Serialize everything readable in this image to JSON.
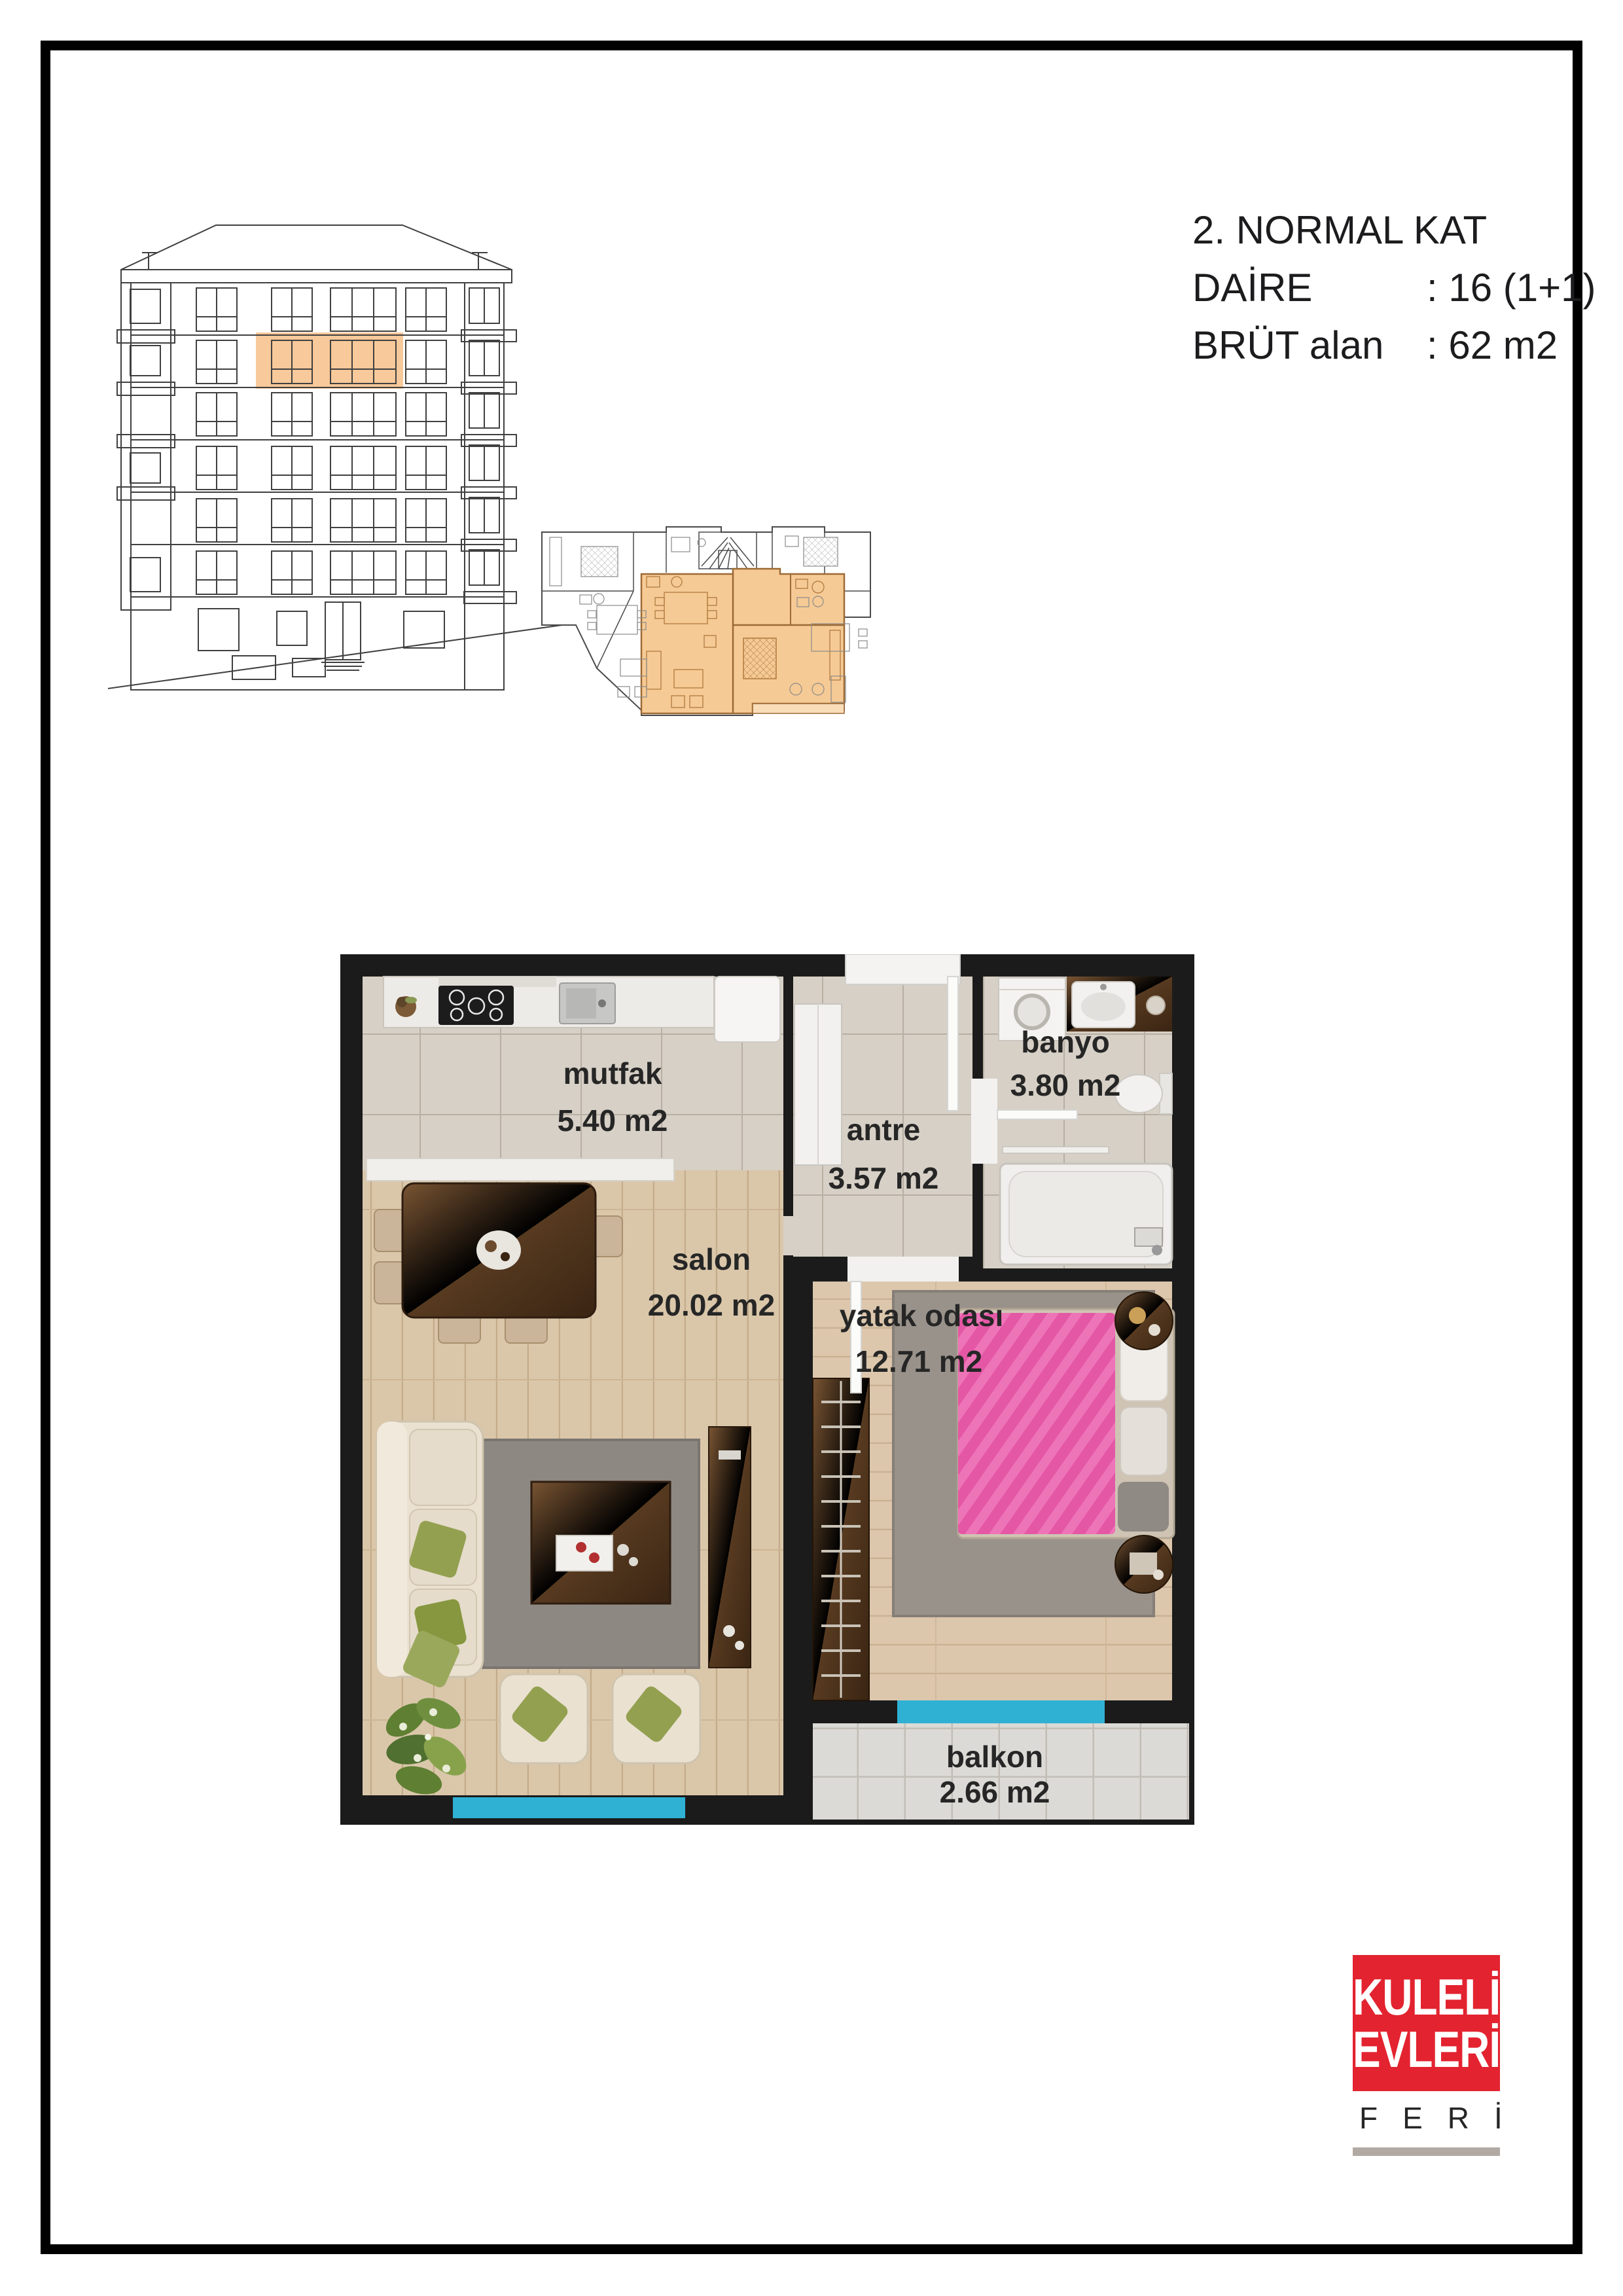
{
  "header": {
    "floor_title": "2. NORMAL KAT",
    "daire_label": "DAİRE",
    "daire_value": ": 16 (1+1)",
    "brut_label": "BRÜT alan",
    "brut_value": ": 62 m2"
  },
  "rooms": {
    "mutfak": {
      "name": "mutfak",
      "area": "5.40 m2"
    },
    "antre": {
      "name": "antre",
      "area": "3.57 m2"
    },
    "banyo": {
      "name": "banyo",
      "area": "3.80 m2"
    },
    "salon": {
      "name": "salon",
      "area": "20.02 m2"
    },
    "yatak": {
      "name": "yatak odası",
      "area": "12.71 m2"
    },
    "balkon": {
      "name": "balkon",
      "area": "2.66 m2"
    }
  },
  "logo": {
    "line1": "KULELİ",
    "line2": "EVLERİ",
    "subtitle": "FERİ"
  },
  "colors": {
    "highlight_orange": "#f6ca95",
    "window_cyan": "#2fb1d4",
    "logo_red": "#e32330",
    "logo_bar_gray": "#b2aaa2",
    "wall_black": "#1b1b1b",
    "bed_pink": "#e457a5"
  }
}
